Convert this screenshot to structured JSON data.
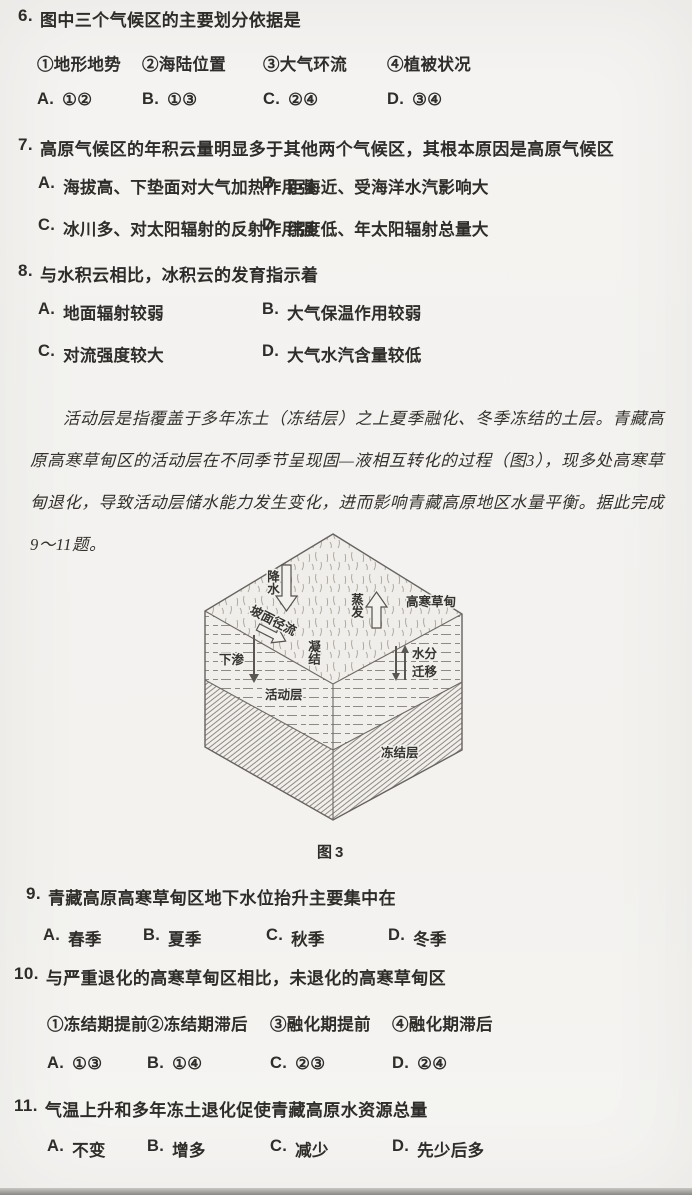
{
  "passage": "活动层是指覆盖于多年冻土（冻结层）之上夏季融化、冬季冻结的土层。青藏高原高寒草甸区的活动层在不同季节呈现固—液相互转化的过程（图3），现多处高寒草甸退化，导致活动层储水能力发生变化，进而影响青藏高原地区水量平衡。据此完成9～11题。",
  "q6": {
    "number": "6.",
    "stem": "图中三个气候区的主要划分依据是",
    "subs": [
      "①地形地势",
      "②海陆位置",
      "③大气环流",
      "④植被状况"
    ],
    "choices": [
      {
        "label": "A.",
        "text": "①②"
      },
      {
        "label": "B.",
        "text": "①③"
      },
      {
        "label": "C.",
        "text": "②④"
      },
      {
        "label": "D.",
        "text": "③④"
      }
    ]
  },
  "q7": {
    "number": "7.",
    "stem": "高原气候区的年积云量明显多于其他两个气候区，其根本原因是高原气候区",
    "choices": [
      {
        "label": "A.",
        "text": "海拔高、下垫面对大气加热作用强"
      },
      {
        "label": "B.",
        "text": "距海近、受海洋水汽影响大"
      },
      {
        "label": "C.",
        "text": "冰川多、对太阳辐射的反射作用强"
      },
      {
        "label": "D.",
        "text": "纬度低、年太阳辐射总量大"
      }
    ]
  },
  "q8": {
    "number": "8.",
    "stem": "与水积云相比，冰积云的发育指示着",
    "choices": [
      {
        "label": "A.",
        "text": "地面辐射较弱"
      },
      {
        "label": "B.",
        "text": "大气保温作用较弱"
      },
      {
        "label": "C.",
        "text": "对流强度较大"
      },
      {
        "label": "D.",
        "text": "大气水汽含量较低"
      }
    ]
  },
  "q9": {
    "number": "9.",
    "stem": "青藏高原高寒草甸区地下水位抬升主要集中在",
    "choices": [
      {
        "label": "A.",
        "text": "春季"
      },
      {
        "label": "B.",
        "text": "夏季"
      },
      {
        "label": "C.",
        "text": "秋季"
      },
      {
        "label": "D.",
        "text": "冬季"
      }
    ]
  },
  "q10": {
    "number": "10.",
    "stem": "与严重退化的高寒草甸区相比，未退化的高寒草甸区",
    "subs": [
      "①冻结期提前",
      "②冻结期滞后",
      "③融化期提前",
      "④融化期滞后"
    ],
    "choices": [
      {
        "label": "A.",
        "text": "①③"
      },
      {
        "label": "B.",
        "text": "①④"
      },
      {
        "label": "C.",
        "text": "②③"
      },
      {
        "label": "D.",
        "text": "②④"
      }
    ]
  },
  "q11": {
    "number": "11.",
    "stem": "气温上升和多年冻土退化促使青藏高原水资源总量",
    "choices": [
      {
        "label": "A.",
        "text": "不变"
      },
      {
        "label": "B.",
        "text": "增多"
      },
      {
        "label": "C.",
        "text": "减少"
      },
      {
        "label": "D.",
        "text": "先少后多"
      }
    ]
  },
  "diagram": {
    "meadow_label": "高寒草甸",
    "precipitation_label": "降水",
    "evaporation_label": "蒸发",
    "slope_runoff_label": "坡面径流",
    "condensation_label": "凝结",
    "infiltration_label": "下渗",
    "moisture_migration_line1": "水分",
    "moisture_migration_line2": "迁移",
    "active_layer_label": "活动层",
    "frozen_layer_label": "冻结层",
    "caption": "图3"
  }
}
